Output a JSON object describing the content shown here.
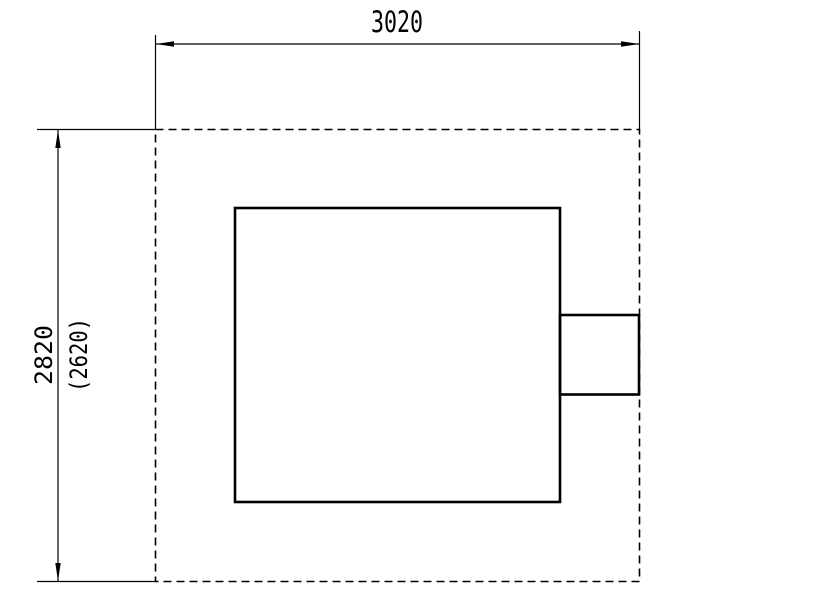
{
  "drawing": {
    "type": "technical-dimension-drawing",
    "background_color": "#ffffff",
    "line_color": "#000000",
    "dimensions": {
      "top_width_label": "3020",
      "left_height_label": "2820",
      "left_height_alt_label": "(2620)"
    }
  }
}
